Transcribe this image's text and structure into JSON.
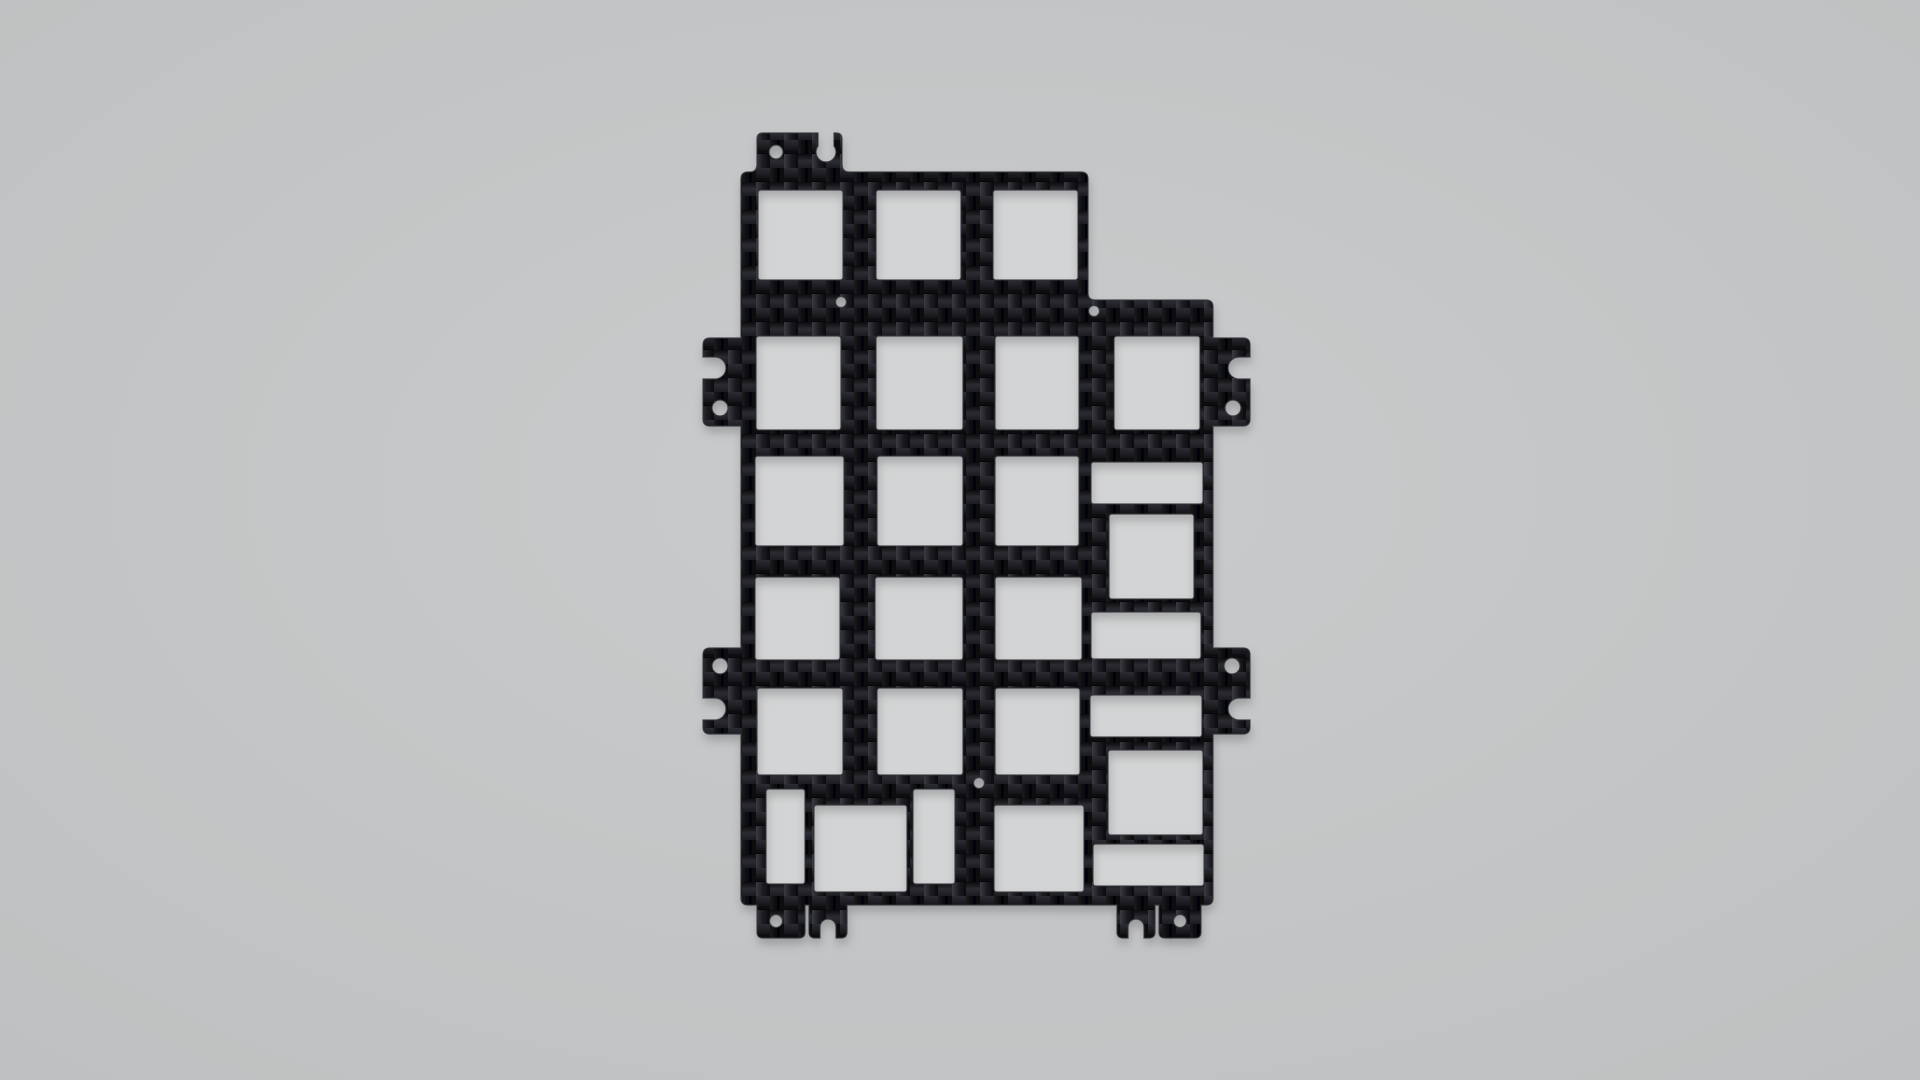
{
  "scene": {
    "object": "carbon-fiber-plate-render",
    "background": {
      "center_color": "#cacbcc",
      "edge_color": "#bec0c1"
    },
    "plate": {
      "material": "carbon-fiber-twill",
      "fiber": {
        "dark": "#050507",
        "deep": "#0a0a0d",
        "mid": "#1b1b20",
        "lit": "#2c2c33",
        "sheen": "#3a3b42",
        "edge_stroke": "#34353b"
      },
      "cutout_floor_color": "#d3d4d5",
      "shadow": {
        "dx": 1,
        "dy": 6,
        "blur": 5,
        "opacity": 0.22
      },
      "outline_path": "M 741 179 Q 741 172 748 172 L 750 172 Q 757 172 757 164 L 757 139 Q 757 133 763 133 L 818 133 L 818 146 A 10 10 0 1 0 834 146 L 834 133 L 836 133 Q 842 133 842 139 L 842 164 Q 842 172 849 172 L 1081 172 Q 1088 172 1088 179 L 1088 293 Q 1088 300 1095 300 L 1206 300 Q 1213 300 1213 307 L 1213 338 L 1243 338 Q 1250 338 1250 345 L 1250 357 L 1239 357 A 11 11 0 0 0 1239 379 L 1250 379 L 1250 419 Q 1250 426 1243 426 L 1213 426 L 1213 648 L 1243 648 Q 1250 648 1250 655 L 1250 698 L 1239 698 A 11 11 0 0 0 1239 720 L 1250 720 L 1250 727 Q 1250 734 1243 734 L 1213 734 L 1213 898 Q 1213 905 1206 905 L 1201 905 L 1201 932 Q 1201 938 1195 938 L 1165 938 Q 1159 938 1159 932 L 1159 905 L 1155 905 L 1155 932 Q 1155 938 1149 938 L 1144 938 L 1144 927 A 8 8 0 0 0 1128 927 L 1128 938 L 1123 938 Q 1117 938 1117 932 L 1117 905 L 847 905 L 847 932 Q 847 938 841 938 L 836 938 L 836 927 A 8 8 0 0 0 820 927 L 820 938 L 815 938 Q 809 938 809 932 L 809 905 L 805 905 L 805 932 Q 805 938 799 938 L 763 938 Q 757 938 757 932 L 757 905 L 748 905 Q 741 905 741 898 L 741 734 L 710 734 Q 703 734 703 727 L 703 720 L 715 720 A 11 11 0 0 0 715 698 L 703 698 L 703 655 Q 703 648 710 648 L 741 648 L 741 426 L 710 426 Q 703 426 703 419 L 703 379 L 715 379 A 11 11 0 0 0 715 357 L 703 357 L 703 345 Q 703 338 710 338 L 741 338 Z",
      "cutout_corner_radius": 3,
      "cutouts": [
        {
          "x": 758,
          "y": 190,
          "w": 85,
          "h": 90
        },
        {
          "x": 876,
          "y": 190,
          "w": 85,
          "h": 90
        },
        {
          "x": 993,
          "y": 190,
          "w": 85,
          "h": 90
        },
        {
          "x": 756,
          "y": 336,
          "w": 85,
          "h": 94
        },
        {
          "x": 876,
          "y": 336,
          "w": 87,
          "h": 94
        },
        {
          "x": 995,
          "y": 336,
          "w": 84,
          "h": 94
        },
        {
          "x": 1114,
          "y": 336,
          "w": 86,
          "h": 94
        },
        {
          "x": 755,
          "y": 456,
          "w": 89,
          "h": 90
        },
        {
          "x": 877,
          "y": 456,
          "w": 86,
          "h": 90
        },
        {
          "x": 995,
          "y": 456,
          "w": 84,
          "h": 90
        },
        {
          "x": 755,
          "y": 577,
          "w": 85,
          "h": 83
        },
        {
          "x": 875,
          "y": 577,
          "w": 88,
          "h": 83
        },
        {
          "x": 995,
          "y": 577,
          "w": 87,
          "h": 83
        },
        {
          "x": 757,
          "y": 688,
          "w": 86,
          "h": 87
        },
        {
          "x": 877,
          "y": 688,
          "w": 86,
          "h": 87
        },
        {
          "x": 995,
          "y": 688,
          "w": 85,
          "h": 87
        },
        {
          "x": 766,
          "y": 789,
          "w": 39,
          "h": 95
        },
        {
          "x": 814,
          "y": 805,
          "w": 93,
          "h": 87
        },
        {
          "x": 913,
          "y": 789,
          "w": 42,
          "h": 95
        },
        {
          "x": 994,
          "y": 805,
          "w": 90,
          "h": 87
        },
        {
          "x": 1091,
          "y": 462,
          "w": 112,
          "h": 42
        },
        {
          "x": 1109,
          "y": 514,
          "w": 85,
          "h": 85
        },
        {
          "x": 1091,
          "y": 612,
          "w": 110,
          "h": 47
        },
        {
          "x": 1090,
          "y": 695,
          "w": 112,
          "h": 42
        },
        {
          "x": 1108,
          "y": 750,
          "w": 95,
          "h": 85
        },
        {
          "x": 1093,
          "y": 844,
          "w": 111,
          "h": 42
        }
      ],
      "screw_holes": [
        {
          "cx": 776,
          "cy": 152,
          "r": 7
        },
        {
          "cx": 720,
          "cy": 408,
          "r": 8
        },
        {
          "cx": 1233,
          "cy": 408,
          "r": 8
        },
        {
          "cx": 720,
          "cy": 666,
          "r": 8
        },
        {
          "cx": 1232,
          "cy": 666,
          "r": 8
        },
        {
          "cx": 776,
          "cy": 921,
          "r": 6.5
        },
        {
          "cx": 1180,
          "cy": 921,
          "r": 6.5
        },
        {
          "cx": 841,
          "cy": 302,
          "r": 5.5
        },
        {
          "cx": 1094,
          "cy": 311,
          "r": 5.5
        },
        {
          "cx": 979,
          "cy": 783,
          "r": 5.5
        }
      ]
    }
  }
}
